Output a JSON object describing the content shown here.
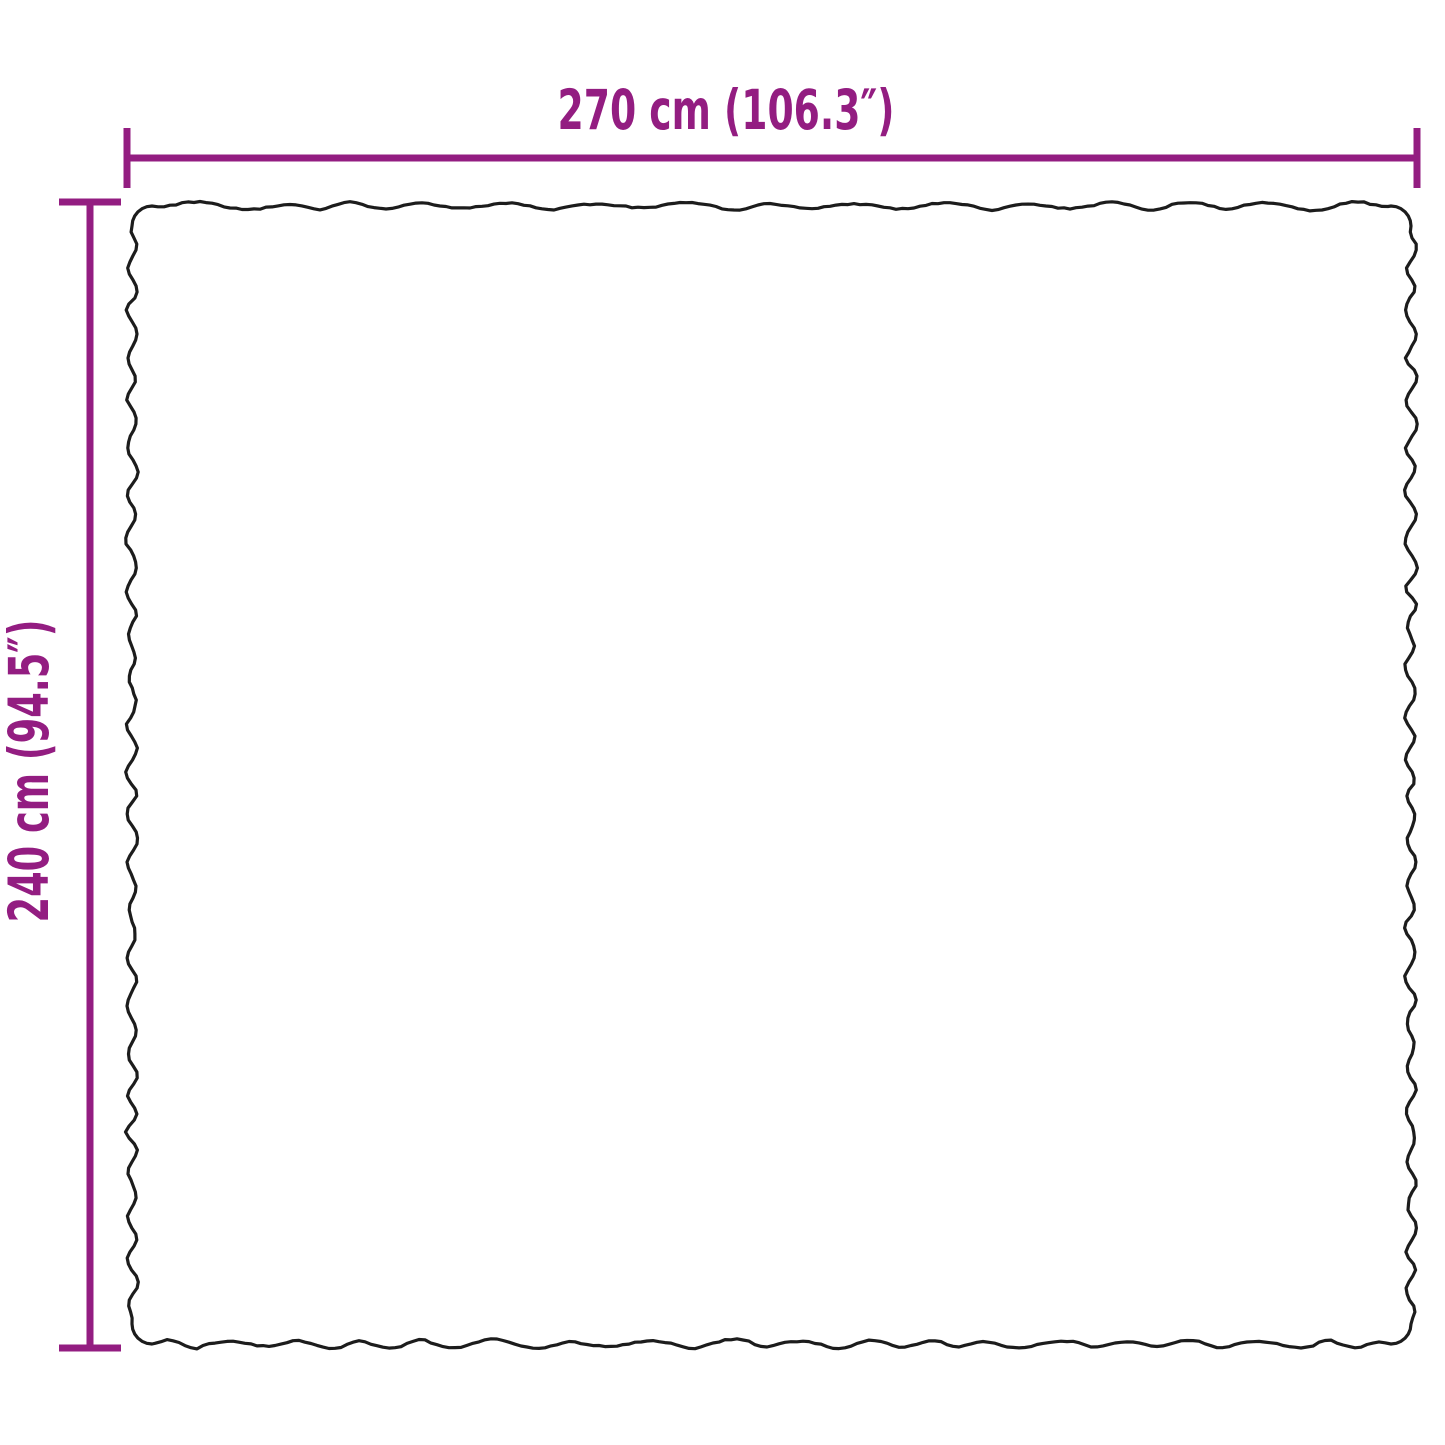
{
  "diagram": {
    "type": "product-dimension-diagram",
    "labels": {
      "width": "270 cm (106.3″)",
      "height": "240 cm (94.5″)"
    },
    "dimensions_shown": {
      "width_cm": 270,
      "width_in": 106.3,
      "height_cm": 240,
      "height_in": 94.5
    }
  },
  "colors": {
    "accent": "#931d81",
    "outline": "#1c1c1c",
    "background": "#ffffff"
  }
}
